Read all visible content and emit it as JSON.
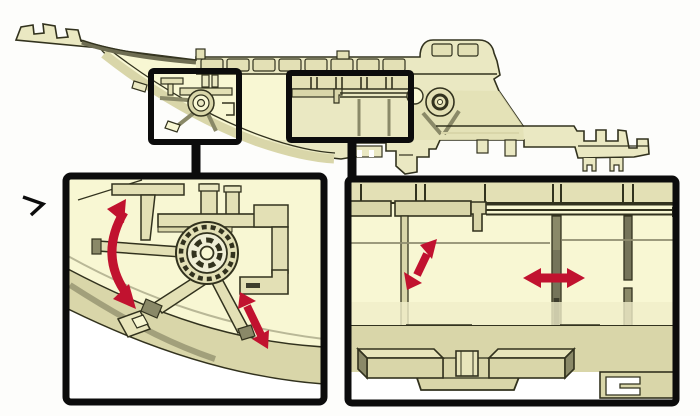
{
  "figure": {
    "kind": "technical-illustration",
    "main_view": "component-side-section-view",
    "callouts": [
      {
        "id": "callout-1",
        "links_to": "left-detail"
      },
      {
        "id": "callout-2",
        "links_to": "right-detail"
      }
    ],
    "details": [
      {
        "id": "left-detail",
        "feature": "pivot-hub-with-spokes",
        "annotations": [
          "curved-rotation-double-arrow",
          "diagonal-double-arrow"
        ]
      },
      {
        "id": "right-detail",
        "feature": "ribbed-panel-with-clip-foot",
        "annotations": [
          "diagonal-double-arrow",
          "horizontal-double-arrow"
        ]
      }
    ],
    "margin_icon": "chevron-right-icon"
  },
  "colors": {
    "background": "#fdfdfb",
    "part_fill": "#eae8c2",
    "part_pale": "#f8f7d3",
    "part_band": "#d9d6a9",
    "part_mid": "#e3e0b5",
    "part_dark": "#75745a",
    "part_deep": "#3d3d2d",
    "part_cap": "#8a8968",
    "part_strip": "#6e6d52",
    "part_shade": "#f0eec9",
    "hub_ring": "#e3e0b6",
    "hub_mid": "#efeed6",
    "pad_top": "#e8e5bb",
    "faint_line": "#8f8d6f",
    "outline": "#32321e",
    "callout": "#0c0c0c",
    "arrow": "#c1122f",
    "white": "#ffffff"
  }
}
